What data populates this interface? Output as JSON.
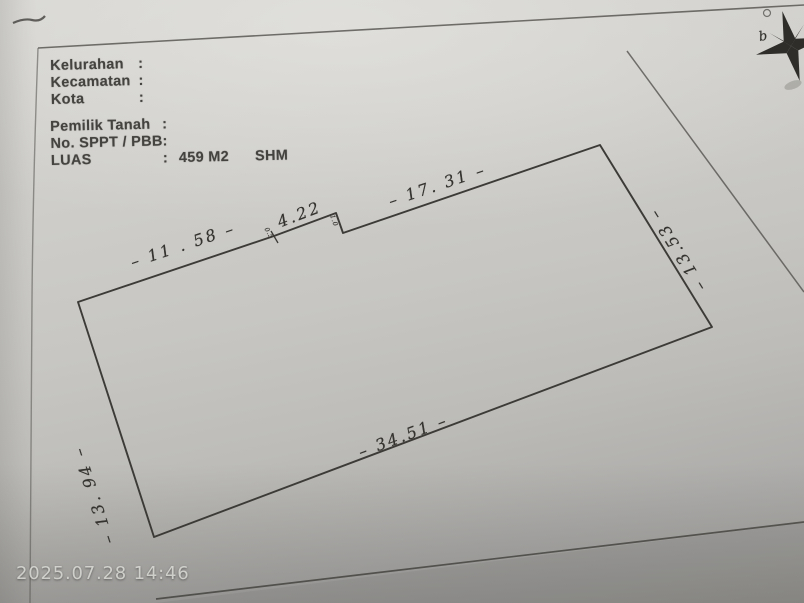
{
  "photo": {
    "timestamp": "2025.07.28 14:46"
  },
  "form": {
    "location_fields": [
      {
        "label": "Kelurahan",
        "colon": ":",
        "value": ""
      },
      {
        "label": "Kecamatan",
        "colon": ":",
        "value": ""
      },
      {
        "label": "Kota",
        "colon": ":",
        "value": ""
      }
    ],
    "property_fields": [
      {
        "label": "Pemilik Tanah",
        "colon": ":",
        "value": ""
      },
      {
        "label": "No. SPPT / PBB",
        "colon": ":",
        "value": ""
      },
      {
        "label": "LUAS",
        "colon": ":",
        "value": "459 M2",
        "tenure": "SHM"
      }
    ]
  },
  "sketch": {
    "measurements": {
      "top_left_segment": "– 11 . 58 –",
      "top_middle_segment": "4.22",
      "top_right_segment": "– 17. 31 –",
      "right_side": "– 13.53 –",
      "bottom_side": "– 34.51 –",
      "left_side": "– 13. 94 –",
      "step_note": "1.0",
      "tick_note": "0.5"
    },
    "compass_letter": "b"
  },
  "colors": {
    "paper_light": "#d6d5d1",
    "paper_dark": "#a2a19d",
    "ink_line": "#3d3b37",
    "printed_text": "#454340",
    "handwriting": "#35332f",
    "timestamp_text": "#ecece8"
  }
}
